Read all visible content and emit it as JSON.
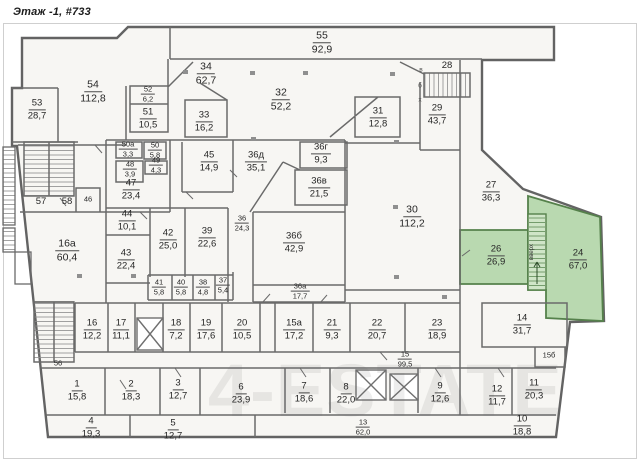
{
  "title": "Этаж -1, #733",
  "watermark": "4-ESTATE",
  "colors": {
    "wall": "#6a6a6a",
    "room_fill": "#f7f6f3",
    "highlight_fill": "#b9d9b0",
    "highlight_border": "#55814b",
    "frame": "#cfcfcf"
  },
  "annotations": {
    "v": "в",
    "b": "б",
    "x": "х",
    "stairs_up": "вверх"
  },
  "rooms": [
    {
      "n": "55",
      "a": "92,9"
    },
    {
      "n": "34",
      "a": "62,7"
    },
    {
      "n": "28",
      "a": ""
    },
    {
      "n": "53",
      "a": "28,7"
    },
    {
      "n": "54",
      "a": "112,8"
    },
    {
      "n": "52",
      "a": "6,2"
    },
    {
      "n": "51",
      "a": "10,5"
    },
    {
      "n": "32",
      "a": "52,2"
    },
    {
      "n": "33",
      "a": "16,2"
    },
    {
      "n": "31",
      "a": "12,8"
    },
    {
      "n": "29",
      "a": "43,7"
    },
    {
      "n": "50а",
      "a": "3,3"
    },
    {
      "n": "50",
      "a": "5,8"
    },
    {
      "n": "48",
      "a": "3,9"
    },
    {
      "n": "49",
      "a": "4,3"
    },
    {
      "n": "47",
      "a": "23,4"
    },
    {
      "n": "45",
      "a": "14,9"
    },
    {
      "n": "36д",
      "a": "35,1"
    },
    {
      "n": "36г",
      "a": "9,3"
    },
    {
      "n": "36в",
      "a": "21,5"
    },
    {
      "n": "27",
      "a": "36,3"
    },
    {
      "n": "30",
      "a": "112,2"
    },
    {
      "n": "36б",
      "a": "42,9"
    },
    {
      "n": "26",
      "a": "26,9"
    },
    {
      "n": "24",
      "a": "67,0"
    },
    {
      "n": "16а",
      "a": "60,4"
    },
    {
      "n": "44",
      "a": "10,1"
    },
    {
      "n": "42",
      "a": "25,0"
    },
    {
      "n": "39",
      "a": "22,6"
    },
    {
      "n": "36",
      "a": "24,3"
    },
    {
      "n": "43",
      "a": "22,4"
    },
    {
      "n": "41",
      "a": "5,8"
    },
    {
      "n": "40",
      "a": "5,8"
    },
    {
      "n": "38",
      "a": "4,8"
    },
    {
      "n": "37",
      "a": "5,4"
    },
    {
      "n": "36а",
      "a": "17,7"
    },
    {
      "n": "16",
      "a": "12,2"
    },
    {
      "n": "17",
      "a": "11,1"
    },
    {
      "n": "18",
      "a": "7,2"
    },
    {
      "n": "19",
      "a": "17,6"
    },
    {
      "n": "20",
      "a": "10,5"
    },
    {
      "n": "15а",
      "a": "17,2"
    },
    {
      "n": "21",
      "a": "9,3"
    },
    {
      "n": "22",
      "a": "20,7"
    },
    {
      "n": "23",
      "a": "18,9"
    },
    {
      "n": "14",
      "a": "31,7"
    },
    {
      "n": "15б",
      "a": ""
    },
    {
      "n": "15",
      "a": "99,5"
    },
    {
      "n": "12",
      "a": "11,7"
    },
    {
      "n": "11",
      "a": "20,3"
    },
    {
      "n": "10",
      "a": "18,8"
    },
    {
      "n": "1",
      "a": "15,8"
    },
    {
      "n": "2",
      "a": "18,3"
    },
    {
      "n": "3",
      "a": "12,7"
    },
    {
      "n": "4",
      "a": "19,3"
    },
    {
      "n": "5",
      "a": "12,7"
    },
    {
      "n": "6",
      "a": "23,9"
    },
    {
      "n": "7",
      "a": "18,6"
    },
    {
      "n": "8",
      "a": "22,0"
    },
    {
      "n": "9",
      "a": "12,6"
    },
    {
      "n": "13",
      "a": "62,0"
    },
    {
      "n": "56",
      "a": ""
    },
    {
      "n": "57",
      "a": ""
    },
    {
      "n": "58",
      "a": ""
    },
    {
      "n": "46",
      "a": ""
    }
  ]
}
